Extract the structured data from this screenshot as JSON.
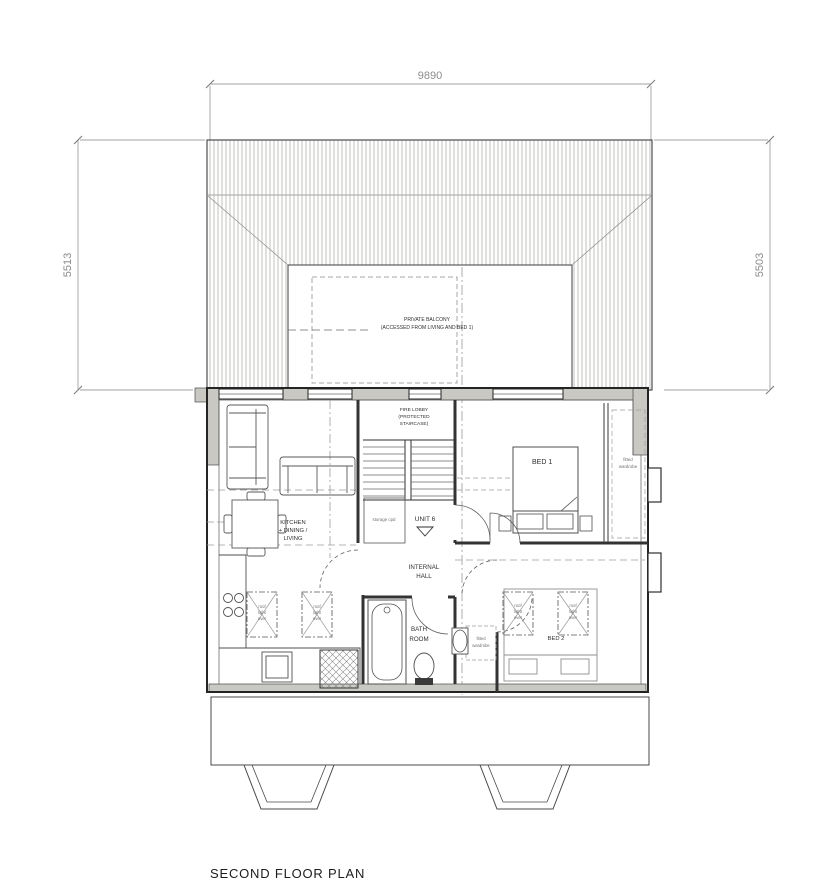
{
  "title": "SECOND FLOOR PLAN",
  "dimensions": {
    "top": "9890",
    "left": "5513",
    "right": "5503"
  },
  "rooms": {
    "balcony_l1": "PRIVATE BALCONY",
    "balcony_l2": "(ACCESSED FROM LIVING AND BED 1)",
    "fire_lobby_l1": "FIRE LOBBY",
    "fire_lobby_l2": "(PROTECTED",
    "fire_lobby_l3": "STAIRCASE)",
    "kitchen_l1": "KITCHEN",
    "kitchen_l2": "+ DINING /",
    "kitchen_l3": "LIVING",
    "bed1": "BED 1",
    "bed2": "BED 2",
    "hall_l1": "INTERNAL",
    "hall_l2": "HALL",
    "bath_l1": "BATH",
    "bath_l2": "ROOM",
    "unit": "UNIT 6",
    "storage": "storage cpd",
    "wardrobe_l1": "fitted",
    "wardrobe_l2": "wardrobe",
    "rooflight_l1": "roof",
    "rooflight_l2": "light",
    "rooflight_l3": "over"
  },
  "colors": {
    "wall_fill": "#c9c8c2",
    "line": "#2f2f2f",
    "dimension": "#8f8f8f",
    "hatch": "#b3b3ad"
  }
}
